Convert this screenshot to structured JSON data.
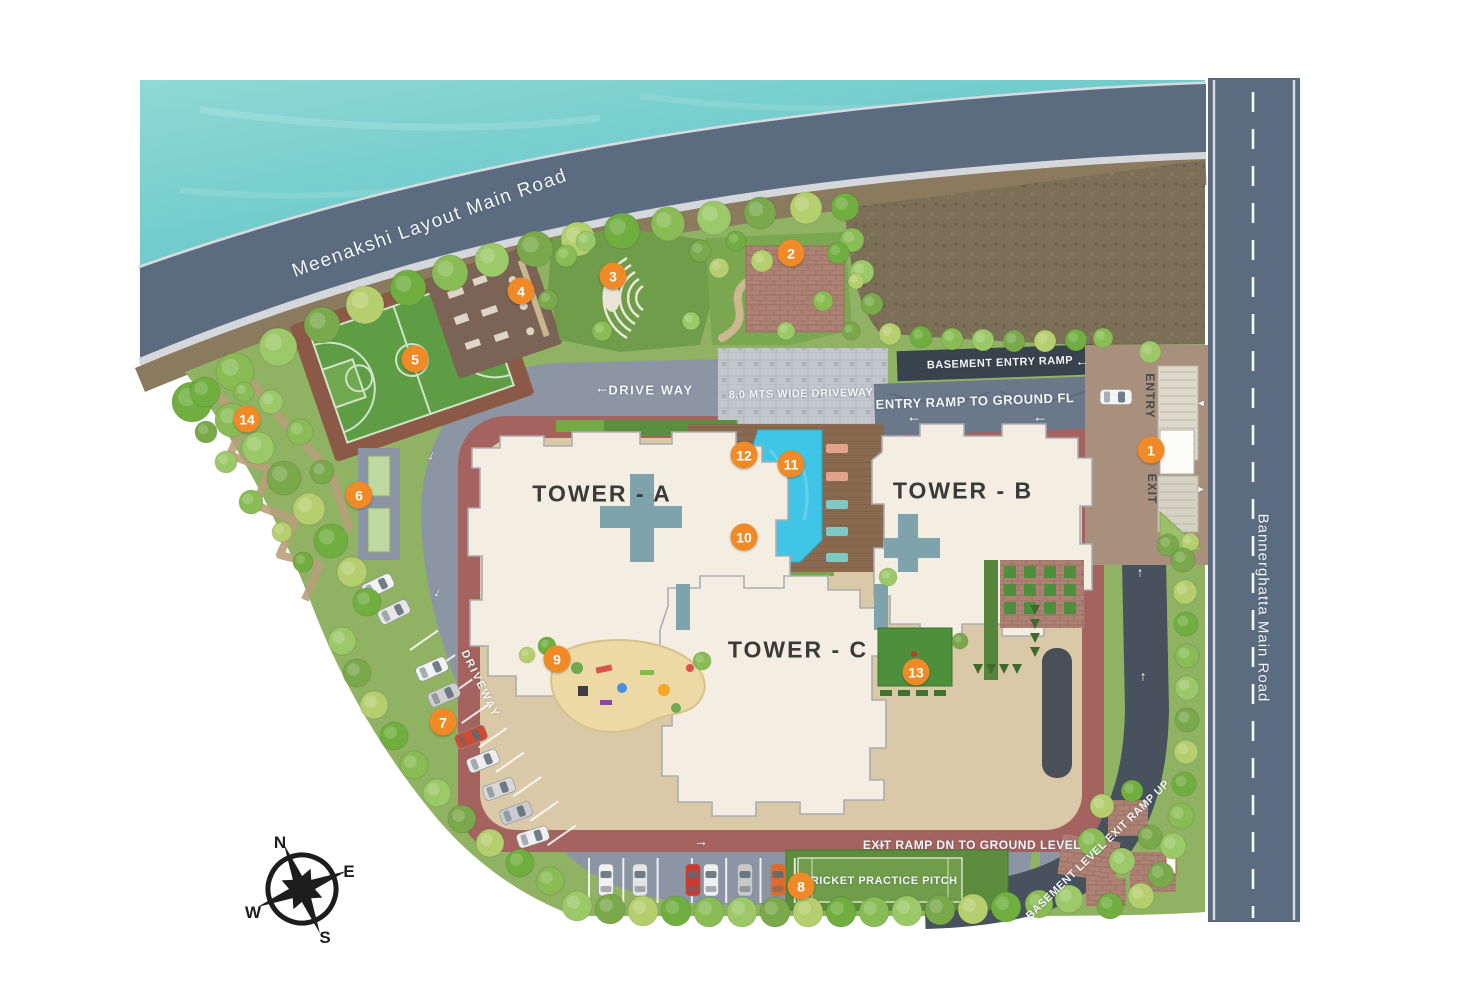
{
  "roads": {
    "meenakshi": "Meenakshi Layout Main Road",
    "bannerghatta": "Bannerghatta Main Road",
    "drive_way": "DRIVE WAY",
    "driveway": "DRIVEWAY",
    "wide_driveway": "8.0 MTS WIDE DRIVEWAY",
    "basement_entry_ramp": "BASEMENT ENTRY RAMP",
    "entry_ramp_to_ground": "ENTRY RAMP TO GROUND FL",
    "exit_ramp_dn": "EXIT RAMP DN TO GROUND LEVEL",
    "basement_level_exit_ramp": "BASEMENT LEVEL EXIT RAMP UP",
    "entry": "ENTRY",
    "exit": "EXIT"
  },
  "towers": {
    "a": "TOWER - A",
    "b": "TOWER - B",
    "c": "TOWER - C"
  },
  "amenities": {
    "cricket_pitch": "CRICKET PRACTICE PITCH"
  },
  "markers": [
    {
      "n": "1",
      "x": 1151,
      "y": 450
    },
    {
      "n": "2",
      "x": 791,
      "y": 253
    },
    {
      "n": "3",
      "x": 613,
      "y": 276
    },
    {
      "n": "4",
      "x": 521,
      "y": 291
    },
    {
      "n": "5",
      "x": 415,
      "y": 359
    },
    {
      "n": "6",
      "x": 359,
      "y": 495
    },
    {
      "n": "7",
      "x": 443,
      "y": 722
    },
    {
      "n": "8",
      "x": 801,
      "y": 886
    },
    {
      "n": "9",
      "x": 557,
      "y": 659
    },
    {
      "n": "10",
      "x": 744,
      "y": 537
    },
    {
      "n": "11",
      "x": 791,
      "y": 464
    },
    {
      "n": "12",
      "x": 744,
      "y": 455
    },
    {
      "n": "13",
      "x": 916,
      "y": 672
    },
    {
      "n": "14",
      "x": 247,
      "y": 419
    }
  ],
  "compass": {
    "n": "N",
    "e": "E",
    "s": "S",
    "w": "W"
  },
  "arrows": {
    "left": "←",
    "right": "→",
    "up": "↑",
    "tri_left": "◄",
    "tri_right": "►"
  },
  "colors": {
    "marker": "#F08A26",
    "water": "#7BCFCF",
    "road": "#5C6C80",
    "dark_road": "#47525E",
    "pool": "#3FC6E6",
    "site_green": "#8FB263",
    "building": "#F3EEE1",
    "maroon": "#A4635F",
    "podium": "#D9C9A6"
  }
}
